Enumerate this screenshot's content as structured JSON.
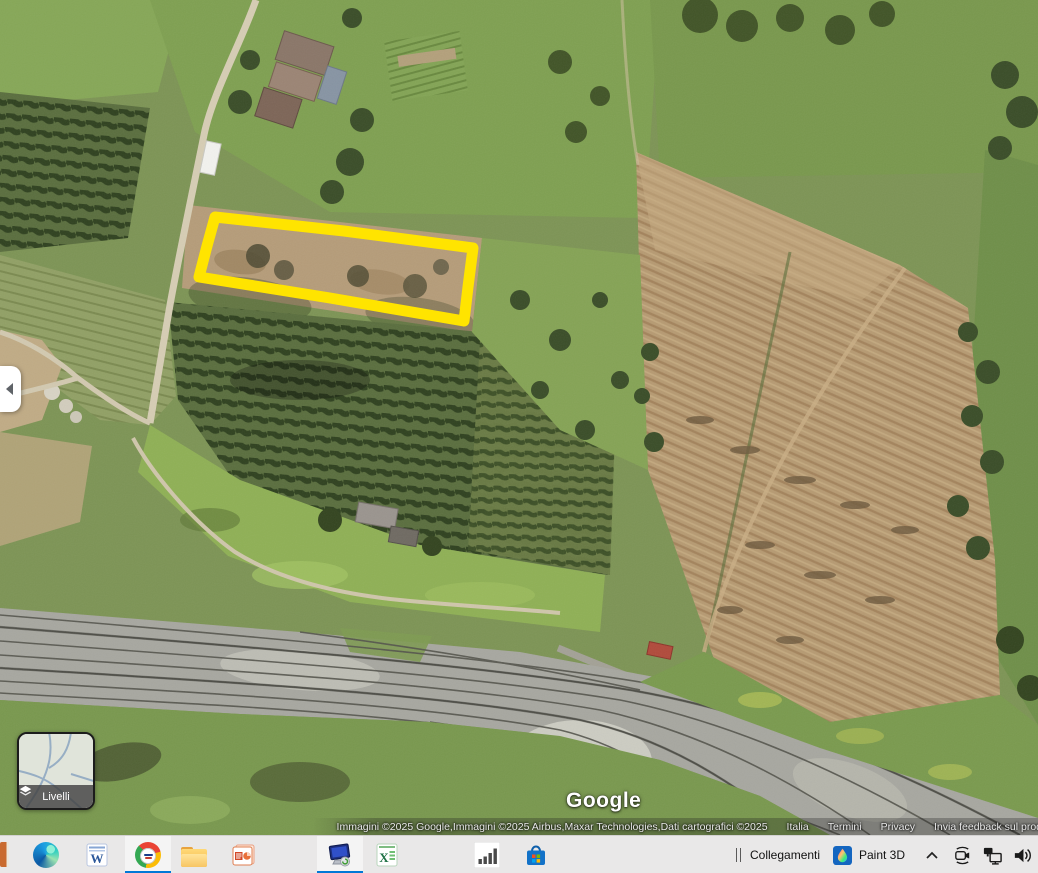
{
  "map": {
    "logo_text": "Google",
    "attribution": "Immagini ©2025 Google,Immagini ©2025 Airbus,Maxar Technologies,Dati cartografici ©2025",
    "links": [
      "Italia",
      "Termini",
      "Privacy",
      "Invia feedback sul prod"
    ],
    "layers_button": {
      "label": "Livelli",
      "icon": "layers-diamond"
    },
    "panel_toggle": {
      "icon": "chevron-left"
    }
  },
  "annotation": {
    "shape": "polygon",
    "color": "#ffe400",
    "stroke_width": 11,
    "points": [
      [
        215,
        217
      ],
      [
        344,
        231
      ],
      [
        473,
        248
      ],
      [
        468,
        287
      ],
      [
        464,
        321
      ],
      [
        330,
        298
      ],
      [
        199,
        277
      ],
      [
        207,
        246
      ]
    ]
  },
  "taskbar": {
    "toolbar_label": "Collegamenti",
    "open_app_label": "Paint 3D",
    "accent_color": "#0078d7",
    "pinned_apps": [
      "partial-app",
      "edge",
      "word",
      "chrome",
      "file-explorer",
      "powerpoint",
      "remote-desktop",
      "excel",
      "stats-app",
      "microsoft-store"
    ],
    "active_apps": [
      "chrome",
      "remote-desktop"
    ],
    "tray_icons": [
      "hidden-icons-chevron",
      "meet-now-camera",
      "network",
      "volume"
    ]
  }
}
